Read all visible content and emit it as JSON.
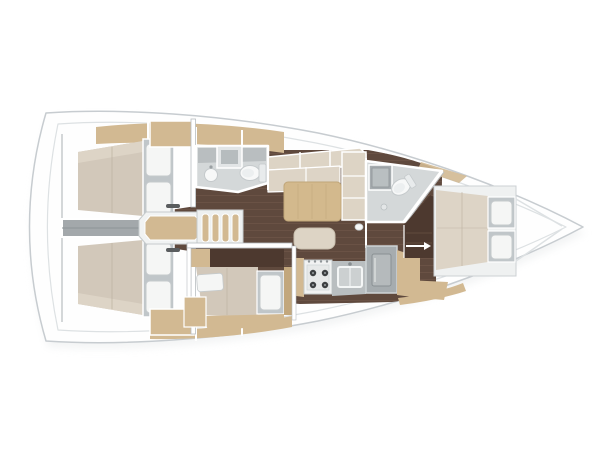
{
  "canvas": {
    "width": 600,
    "height": 450,
    "background": "#ffffff"
  },
  "palette": {
    "background": "#ffffff",
    "hull_fill": "#fefefe",
    "hull_stroke": "#c7ccd0",
    "deck_line": "#dde1e3",
    "boat_shadow": "#e9ebec",
    "wood_floor": "#5f493d",
    "wood_plank_line": "#73594a",
    "wall_white": "#ffffff",
    "wall_shadow": "#b8bdc0",
    "gray_floor": "#d4d8d9",
    "counter_gray": "#b9bec0",
    "steel_gray": "#a6acaf",
    "engine_gray": "#a3a8ab",
    "fixture_white": "#f7f8f8",
    "fixture_stroke": "#c5cacc",
    "mattress": "#d2c8ba",
    "mattress_light": "#ddd4c6",
    "mattress_seam": "#bcb1a1",
    "cushion": "#ddd4c5",
    "pillow": "#f5f6f5",
    "pillow_frame": "#c0c6c9",
    "tan_wood": "#d2b992",
    "tan_wood_dark": "#c2a77d",
    "dark_wood": "#4d392f",
    "table_wood": "#d3b98d",
    "burner_dark": "#3d4042",
    "handle_dark": "#5a5d5f"
  },
  "diagram": {
    "type": "sailboat-interior-floor-plan",
    "orientation": "bow-right",
    "rooms": [
      {
        "name": "aft-cabin-port"
      },
      {
        "name": "aft-cabin-starboard"
      },
      {
        "name": "engine-compartment"
      },
      {
        "name": "companionway"
      },
      {
        "name": "head-aft"
      },
      {
        "name": "saloon"
      },
      {
        "name": "galley"
      },
      {
        "name": "mid-cabin-starboard"
      },
      {
        "name": "head-forward"
      },
      {
        "name": "forward-cabin"
      }
    ],
    "fixtures": [
      "double-berth",
      "pillows",
      "companionway-ladder",
      "toilet",
      "washbasin",
      "shower-unit",
      "stove-4-burner",
      "galley-sink",
      "refrigerator",
      "saloon-table",
      "l-settee",
      "stool",
      "wardrobe-lockers"
    ]
  }
}
